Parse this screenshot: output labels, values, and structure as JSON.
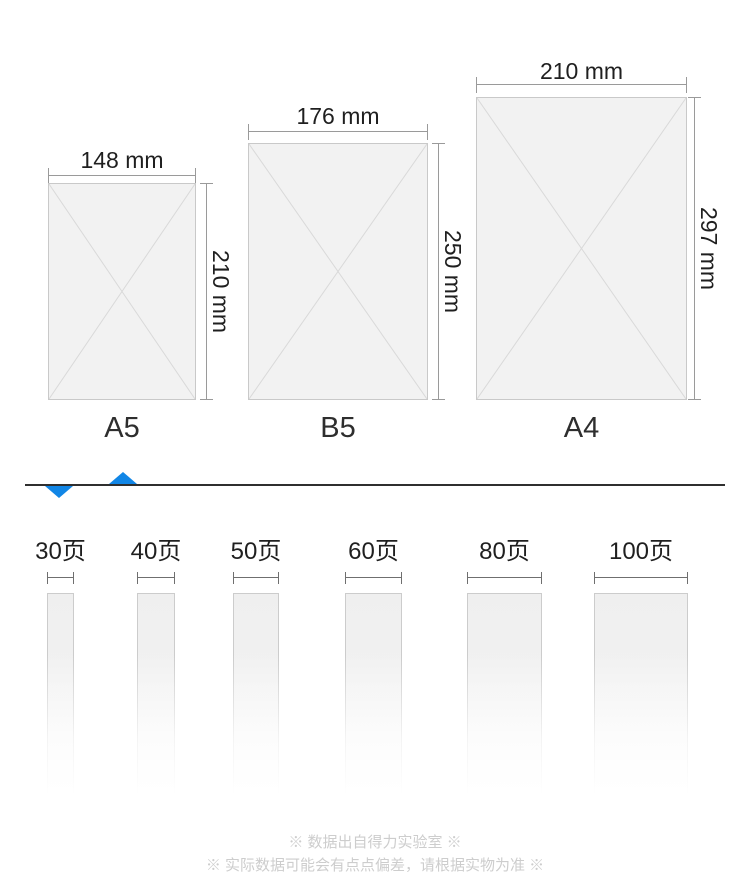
{
  "papers": {
    "items": [
      {
        "name": "A5",
        "width_label": "148 mm",
        "height_label": "210 mm"
      },
      {
        "name": "B5",
        "width_label": "176 mm",
        "height_label": "250 mm"
      },
      {
        "name": "A4",
        "width_label": "210 mm",
        "height_label": "297 mm"
      }
    ]
  },
  "pages": {
    "items": [
      {
        "label": "30页"
      },
      {
        "label": "40页"
      },
      {
        "label": "50页"
      },
      {
        "label": "60页"
      },
      {
        "label": "80页"
      },
      {
        "label": "100页"
      }
    ]
  },
  "footnotes": {
    "line1": "※ 数据出自得力实验室 ※",
    "line2": "※ 实际数据可能会有点点偏差，请根据实物为准 ※"
  },
  "colors": {
    "accent_blue": "#1186e6",
    "box_fill": "#f2f2f2",
    "box_border": "#c9c9c9",
    "dim_line": "#9a9a9a",
    "footnote_text": "#cdcdcd"
  }
}
